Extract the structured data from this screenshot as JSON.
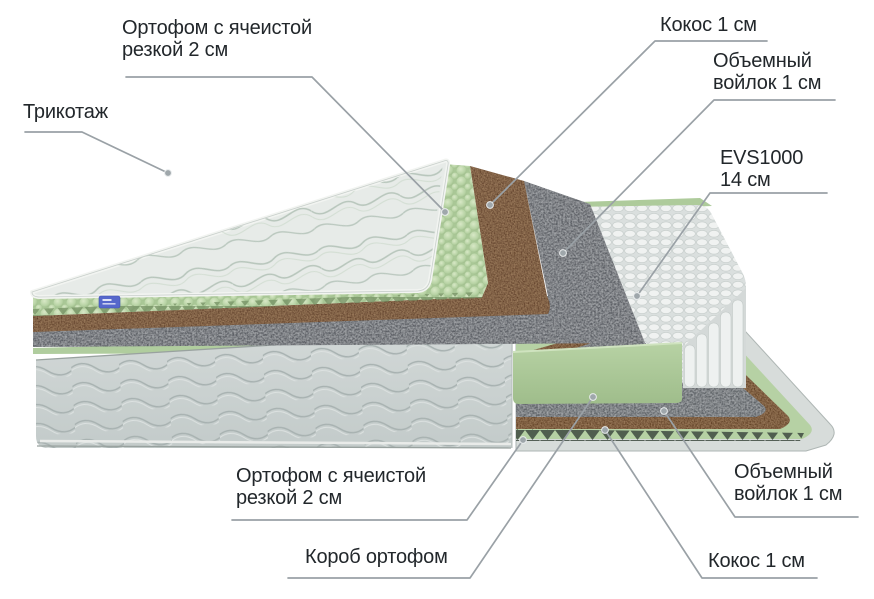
{
  "diagram": {
    "type": "mattress-layers-cutaway-diagram",
    "labels": {
      "ortofom_top": {
        "line1": "Ортофом с ячеистой",
        "line2": "резкой 2 см"
      },
      "trikotazh": {
        "line1": "Трикотаж"
      },
      "kokos_top": {
        "line1": "Кокос 1 см"
      },
      "voilok_top": {
        "line1": "Объемный",
        "line2": "войлок 1 см"
      },
      "evs": {
        "line1": "EVS1000",
        "line2": "14 см"
      },
      "ortofom_bottom": {
        "line1": "Ортофом с ячеистой",
        "line2": "резкой 2 см"
      },
      "korob": {
        "line1": "Короб ортофом"
      },
      "voilok_bottom": {
        "line1": "Объемный",
        "line2": "войлок 1 см"
      },
      "kokos_bottom": {
        "line1": "Кокос 1 см"
      }
    },
    "colors": {
      "label_text": "#22272b",
      "leader_line": "#9aa1a6",
      "quilted_top_fabric": "#e7ebe8",
      "foam_green": "#b2cf9f",
      "coconut_brown": "#61402a",
      "felt_gray": "#5f6368",
      "springs_white": "#eef1f0",
      "box_fabric_gray": "#cbd2d1",
      "brand_tag_blue": "#5668cb",
      "background": "#ffffff"
    }
  }
}
